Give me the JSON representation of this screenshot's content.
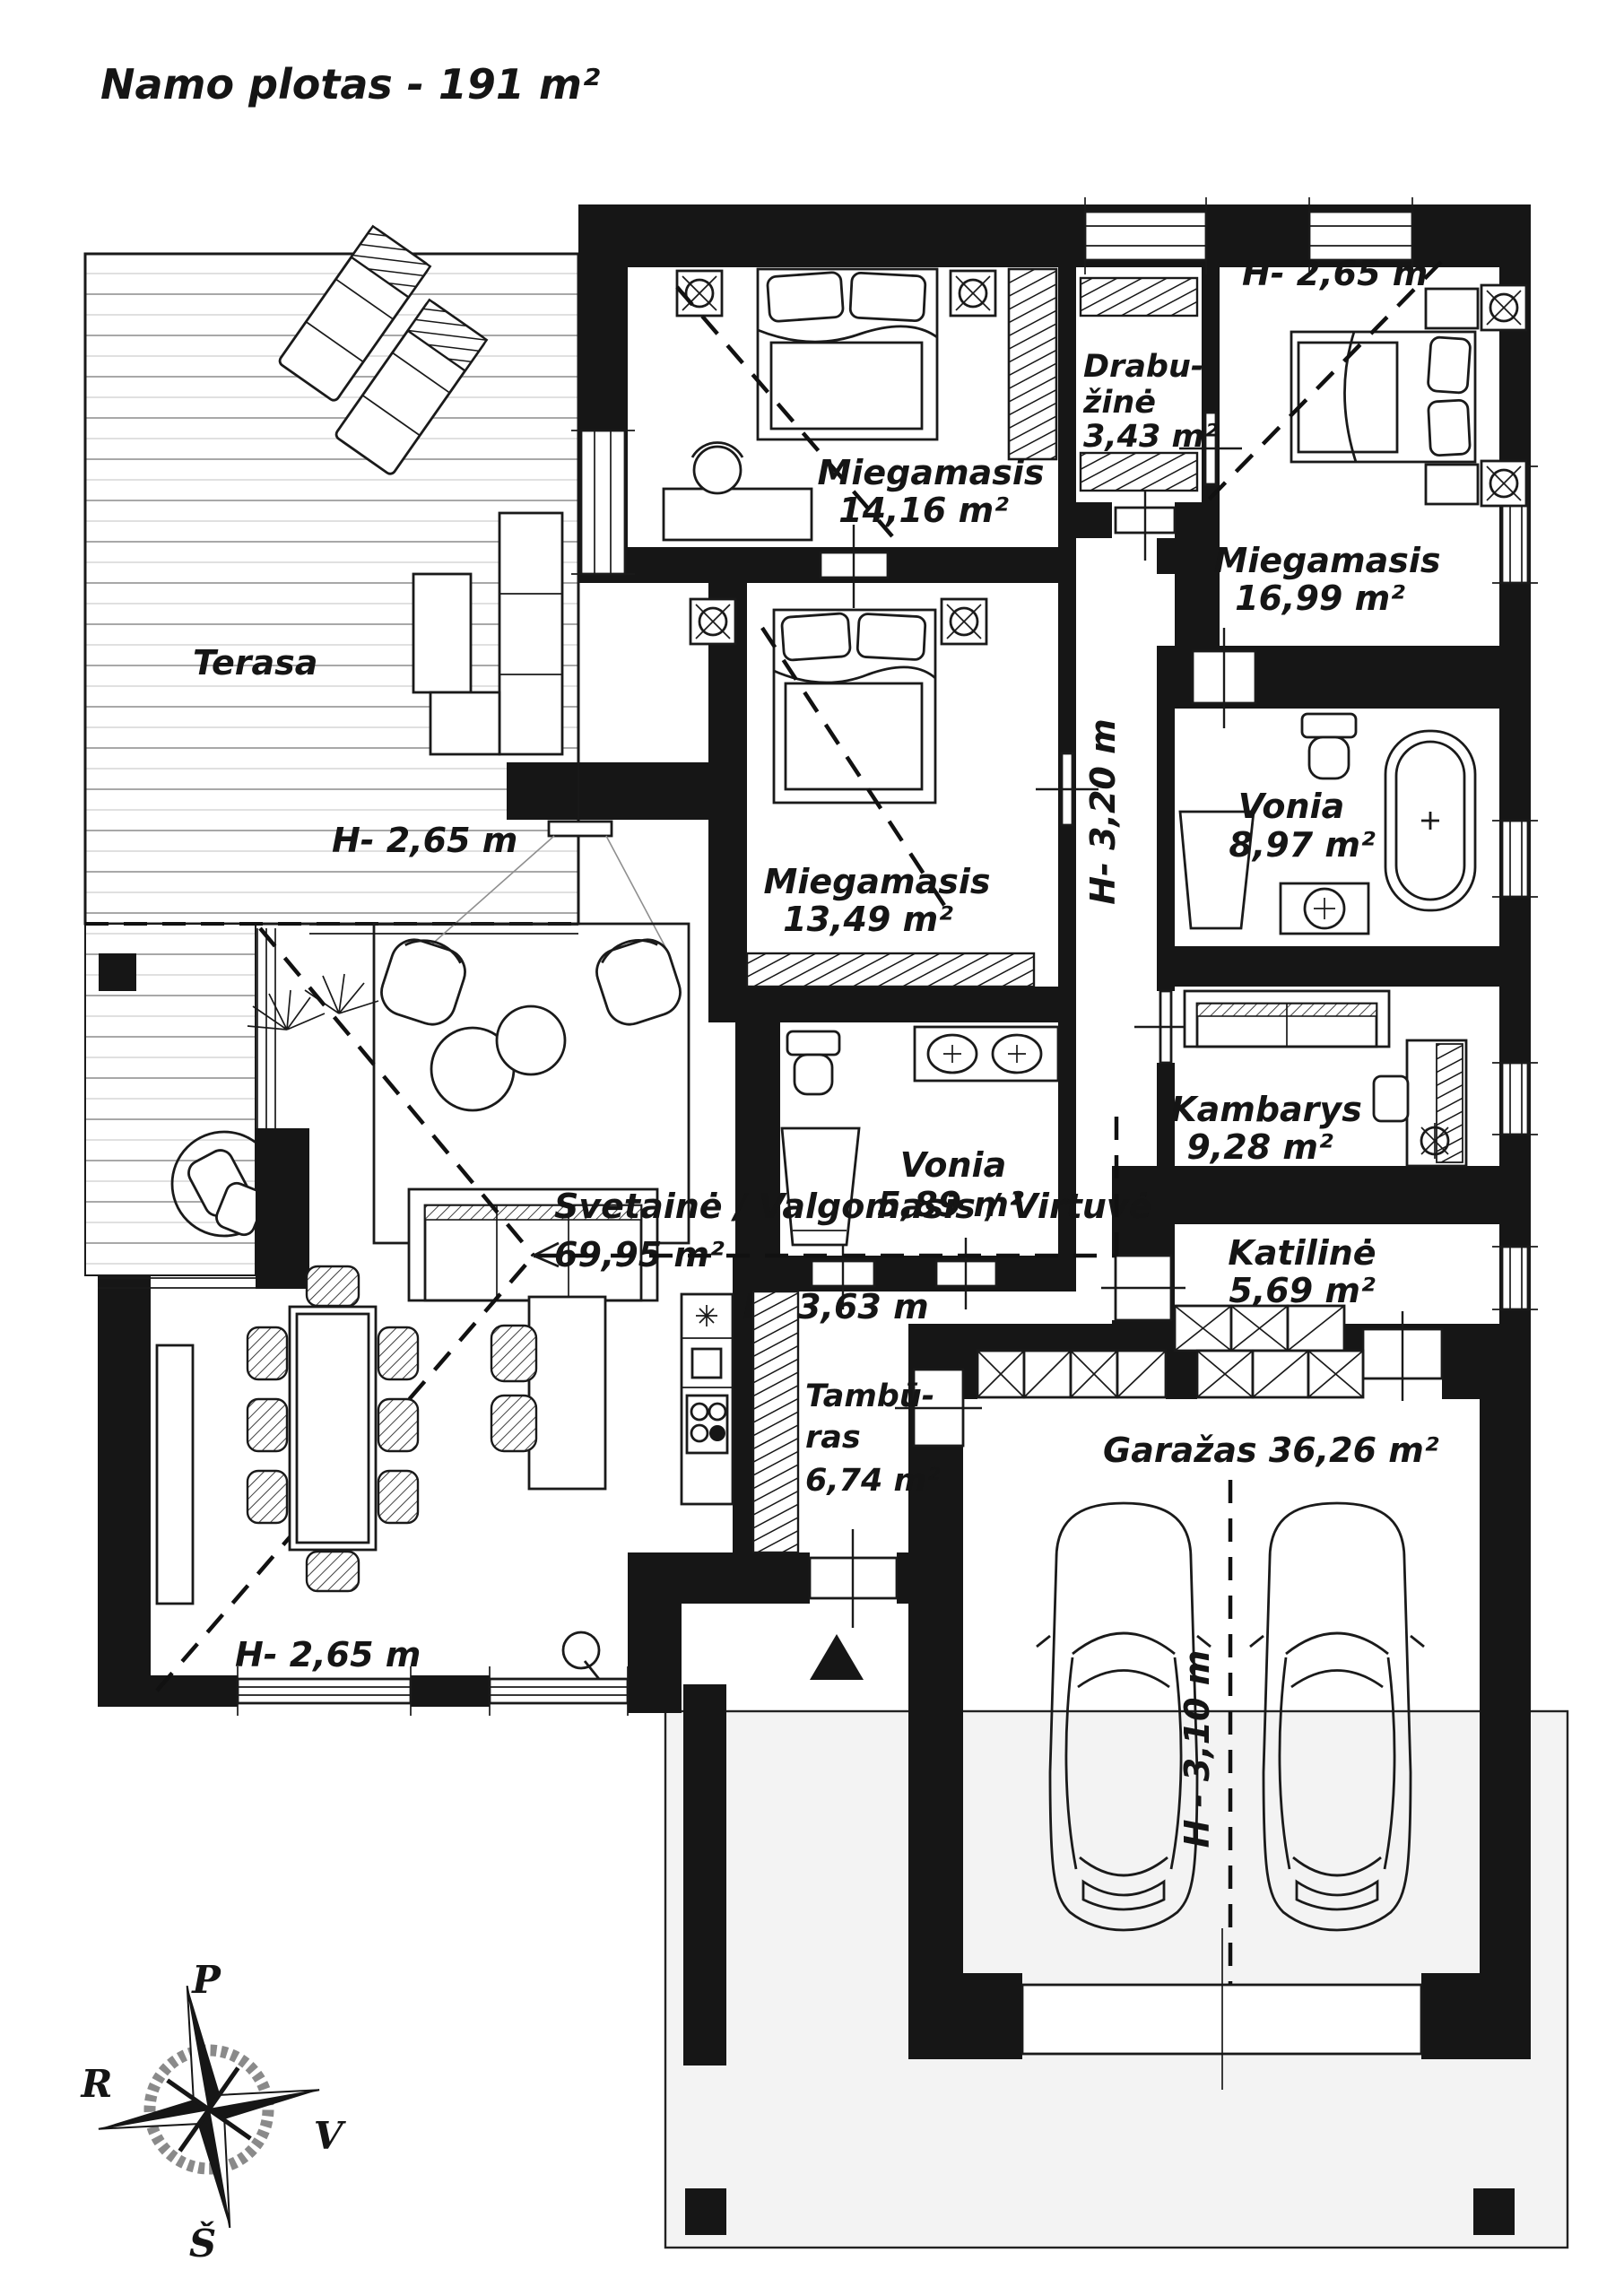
{
  "title": "Namo plotas - 191 m²",
  "rooms": {
    "terasa": "Terasa",
    "miegamasis1_name": "Miegamasis",
    "miegamasis1_area": "14,16 m²",
    "drabuzine_l1": "Drabu-",
    "drabuzine_l2": "žinė",
    "drabuzine_area": "3,43 m²",
    "miegamasis3_name": "Miegamasis",
    "miegamasis3_area": "16,99 m²",
    "miegamasis2_name": "Miegamasis",
    "miegamasis2_area": "13,49 m²",
    "vonia_small_name": "Vonia",
    "vonia_small_area": "5,89 m²",
    "vonia_big_name": "Vonia",
    "vonia_big_area": "8,97 m²",
    "kambarys_name": "Kambarys",
    "kambarys_area": "9,28 m²",
    "katiline_name": "Katilinė",
    "katiline_area": "5,69 m²",
    "svetaine_name": "Svetainė / Valgomasis / Virtuvė",
    "svetaine_area": "69,95 m²",
    "tamburas_l1": "Tambū-",
    "tamburas_l2": "ras",
    "tamburas_area": "6,74 m²",
    "garazas": "Garažas 36,26 m²"
  },
  "heights": {
    "bedroom3": "H- 2,65 m",
    "living": "H- 2,65 m",
    "dining": "H- 2,65 m",
    "corridor": "H- 3,20 m",
    "kitchen": "H- 3,63 m",
    "garage": "H - 3,10 m"
  },
  "compass": {
    "north": "P",
    "west": "R",
    "east": "V",
    "south": "Š"
  }
}
